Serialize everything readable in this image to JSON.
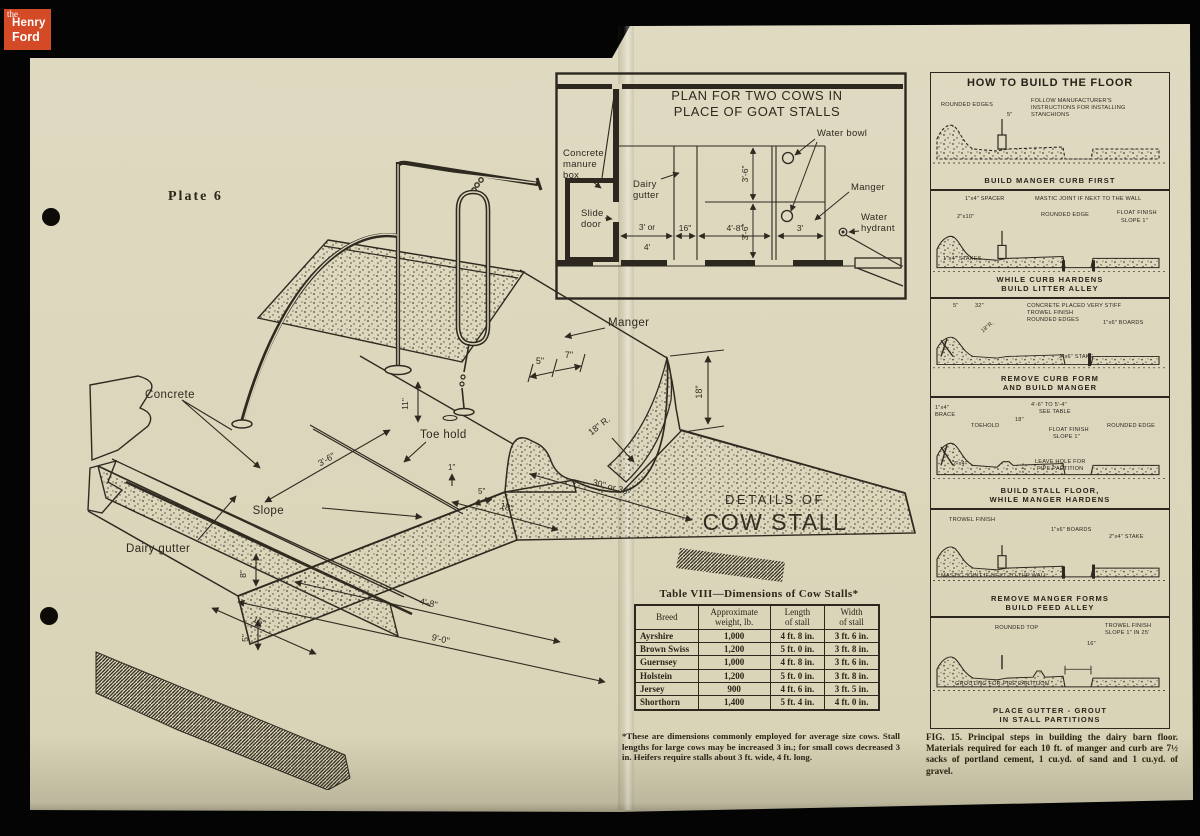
{
  "logo": {
    "the": "the",
    "henry": "Henry",
    "ford": "Ford"
  },
  "page": {
    "plate": "Plate 6"
  },
  "colors": {
    "paper": "#dcd6bc",
    "ink": "#2e2a20",
    "logo_red": "#d54a26"
  },
  "drawing": {
    "title1": "DETAILS OF",
    "title2": "COW STALL",
    "labels": {
      "concrete": "Concrete",
      "dairy_gutter": "Dairy gutter",
      "slope": "Slope",
      "toe_hold": "Toe hold",
      "manger": "Manger"
    },
    "dims": {
      "slope_len": "3'-6\"",
      "base_w": "16\"",
      "floor_len": "4'-8\"",
      "overall": "9'-0\"",
      "front_strip": "18\"",
      "manger_w": "30\" or 36\"",
      "curb_5": "5\"",
      "curb_7": "7\"",
      "radius": "18\" R.",
      "manger_d": "18\"",
      "toe_h": "1\"",
      "toe_w": "5\"",
      "gutter_d": "8\"",
      "gutter_d2": "5\"",
      "curb_h": "11\""
    }
  },
  "plan": {
    "title1": "PLAN FOR TWO COWS IN",
    "title2": "PLACE OF GOAT STALLS",
    "labels": {
      "manure": [
        "Concrete",
        "manure",
        "box"
      ],
      "slide": [
        "Slide",
        "door"
      ],
      "dairy": [
        "Dairy",
        "gutter"
      ],
      "water_bowl": "Water bowl",
      "manger": "Manger",
      "hydrant": [
        "Water",
        "hydrant"
      ]
    },
    "dims": {
      "w1a": "3' or",
      "w1b": "4'",
      "w2": "16\"",
      "w3": "4'-8\"",
      "w4": "3'",
      "v1": "3'-6\"",
      "v2": "3'-6\""
    }
  },
  "howto": {
    "title": "HOW TO BUILD THE FLOOR",
    "panels": [
      {
        "labels": [
          "ROUNDED EDGES",
          "FOLLOW MANUFACTURER'S",
          "INSTRUCTIONS FOR INSTALLING",
          "STANCHIONS",
          "5\""
        ],
        "caption": [
          "BUILD MANGER CURB FIRST"
        ]
      },
      {
        "labels": [
          "1\"x4\" SPACER",
          "MASTIC JOINT IF NEXT TO THE WALL",
          "2\"x10\"",
          "ROUNDED EDGE",
          "FLOAT FINISH",
          "SLOPE 1\"",
          "1\"x4\" STAKES"
        ],
        "caption": [
          "WHILE CURB HARDENS",
          "BUILD LITTER ALLEY"
        ]
      },
      {
        "labels": [
          "5\"",
          "32\"",
          "CONCRETE PLACED VERY STIFF",
          "TROWEL FINISH",
          "ROUNDED EDGES",
          "18\"R.",
          "1\"x6\" BOARDS",
          "2\"x6\" STAKE"
        ],
        "caption": [
          "REMOVE CURB FORM",
          "AND BUILD MANGER"
        ]
      },
      {
        "labels": [
          "1\"x4\"",
          "BRACE",
          "TOEHOLD",
          "4'-6\" TO 5'-4\"",
          "SEE TABLE",
          "18\"",
          "FLOAT FINISH",
          "SLOPE 1\"",
          "ROUNDED EDGE",
          "LEAVE HOLE FOR",
          "PIPE PARTITION",
          "2\"x4\""
        ],
        "caption": [
          "BUILD STALL FLOOR,",
          "WHILE MANGER HARDENS"
        ]
      },
      {
        "labels": [
          "TROWEL FINISH",
          "1\"x6\" BOARDS",
          "2\"x4\" STAKE",
          "MASTIC JOINT IF NEXT TO THE WALL"
        ],
        "caption": [
          "REMOVE MANGER FORMS",
          "BUILD FEED ALLEY"
        ]
      },
      {
        "labels": [
          "ROUNDED TOP",
          "TROWEL FINISH",
          "SLOPE 1\" IN 25'",
          "16\"",
          "GROUTING FOR PIPE PARTITION"
        ],
        "caption": [
          "PLACE GUTTER - GROUT",
          "IN STALL PARTITIONS"
        ]
      }
    ]
  },
  "table": {
    "title": "Table VIII—Dimensions of Cow Stalls*",
    "headers": [
      "Breed",
      "Approximate\nweight, lb.",
      "Length\nof stall",
      "Width\nof stall"
    ],
    "rows": [
      [
        "Ayrshire",
        "1,000",
        "4 ft. 8 in.",
        "3 ft. 6 in."
      ],
      [
        "Brown Swiss",
        "1,200",
        "5 ft. 0 in.",
        "3 ft. 8 in."
      ],
      [
        "Guernsey",
        "1,000",
        "4 ft. 8 in.",
        "3 ft. 6 in."
      ],
      [
        "Holstein",
        "1,200",
        "5 ft. 0 in.",
        "3 ft. 8 in."
      ],
      [
        "Jersey",
        "900",
        "4 ft. 6 in.",
        "3 ft. 5 in."
      ],
      [
        "Shorthorn",
        "1,400",
        "5 ft. 4 in.",
        "4 ft. 0 in."
      ]
    ],
    "footnote": "*These are dimensions commonly employed for average size cows. Stall lengths for large cows may be increased 3 in.; for small cows decreased 3 in. Heifers require stalls about 3 ft. wide, 4 ft. long."
  },
  "fig": {
    "caption": "FIG. 15. Principal steps in building the dairy barn floor. Materials required for each 10 ft. of manger and curb are 7½ sacks of portland cement, 1 cu.yd. of sand and 1 cu.yd. of gravel."
  }
}
